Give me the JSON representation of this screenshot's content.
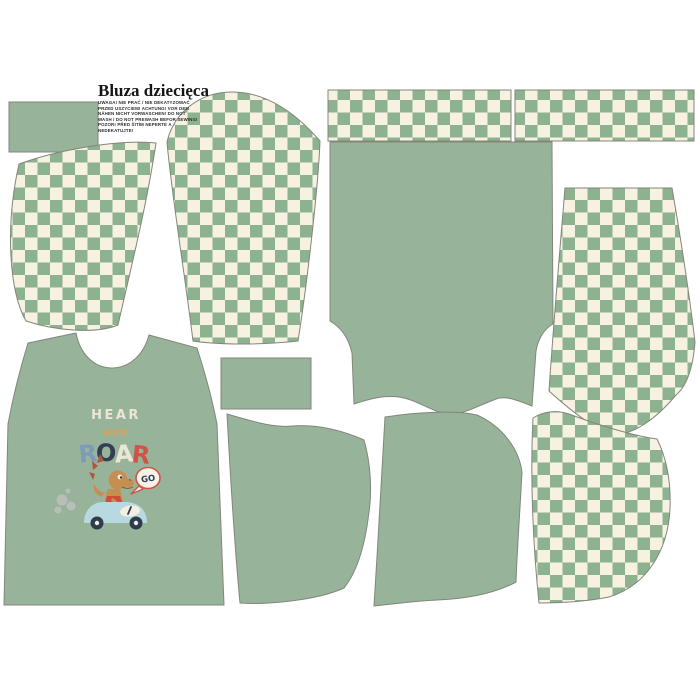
{
  "header": {
    "title": "Bluza dziecięca",
    "care_lines": [
      "UWAGA! NIE PRAĆ / NIE DEKATYZOWAĆ",
      "PRZED USZYCIEM! ACHTUNG! VOR DEM",
      "NÄHEN NICHT VORWASCHEN! DO NOT",
      "WASH / DO NOT PREWASH BEFOR SEWING!",
      "POZOR! PŘED ŠITÍM NEPERTE A",
      "NEDEKATUJTE!"
    ]
  },
  "graphic": {
    "line1": "HEAR",
    "line2": "HiM",
    "roar_letters": [
      {
        "char": "R",
        "color": "#7c9bb8"
      },
      {
        "char": "O",
        "color": "#323f55"
      },
      {
        "char": "A",
        "color": "#ece6d4"
      },
      {
        "char": "R",
        "color": "#cf5348"
      }
    ],
    "bubble_text": "GO"
  },
  "colors": {
    "solid_green": "#97b49a",
    "checker_green": "#8db290",
    "checker_cream": "#f7f1e1",
    "outline": "#83867a",
    "background": "#ffffff",
    "graphic_cream": "#ece6d4",
    "graphic_orange": "#e0a04f",
    "graphic_navy": "#323f55",
    "graphic_red": "#cf5348",
    "car_blue": "#b7d9df",
    "dino_tan": "#c78e52",
    "dino_spike": "#b2573b",
    "smoke_gray": "#b9bfb8"
  },
  "pieces": [
    "cuff-rect-left",
    "sleeve-checkered-left",
    "sleeve-checkered-right",
    "neckband-strip-1",
    "neckband-strip-2",
    "back-panel",
    "hood-checkered-upper",
    "cuff-rect-center",
    "front-panel",
    "pocket-left",
    "pocket-right",
    "hood-checkered-lower"
  ]
}
